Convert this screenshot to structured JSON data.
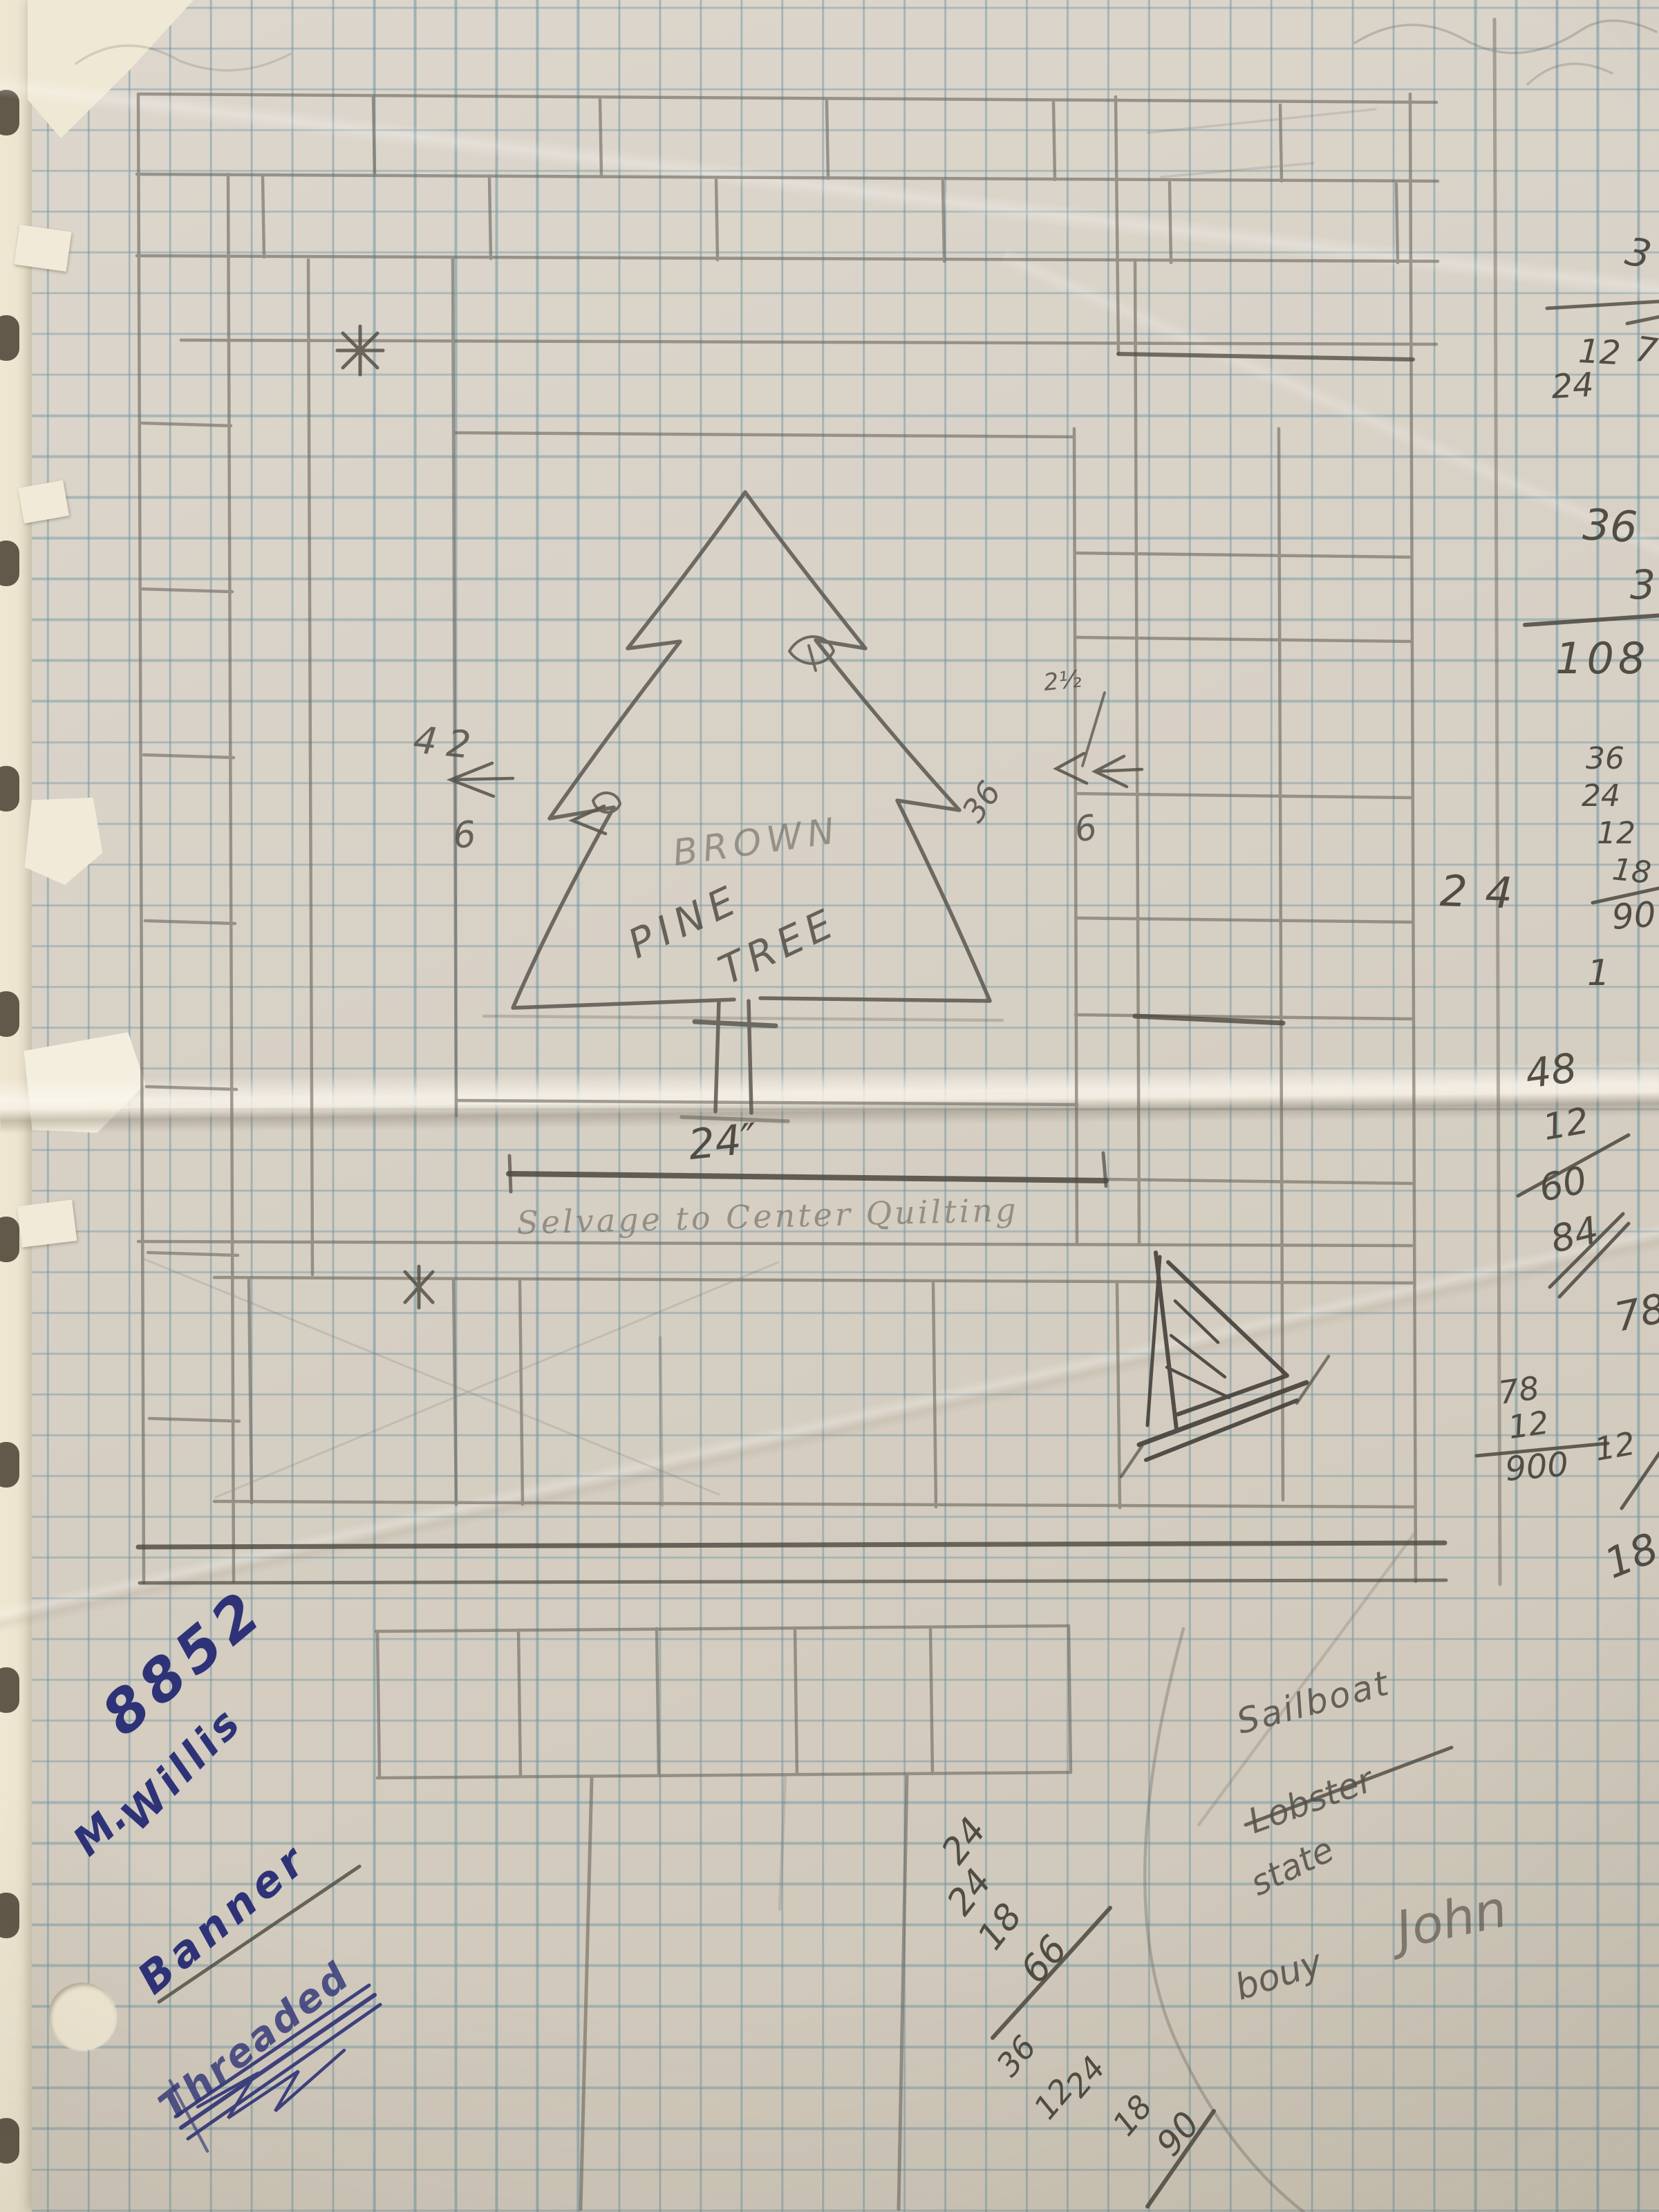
{
  "sketch_labels": {
    "tree_color_word": "BROWN",
    "tree_line1": "PINE",
    "tree_line2": "TREE",
    "center_width": "24″",
    "cursive_note": "Selvage to Center Quilting",
    "left_height": "42",
    "left_small": "6",
    "right_rotated": "36",
    "right_fraction": "2½",
    "right_small": "6"
  },
  "margin_math": {
    "edge_fragment_top": "3",
    "edge_fragment_seven": "7",
    "pair_top": "12",
    "pair_bottom": "24",
    "multiplication": {
      "multiplicand": "36",
      "multiplier": "3",
      "product": "108"
    },
    "addition": {
      "addends": [
        "36",
        "24",
        "12",
        "18"
      ],
      "sum": "90"
    },
    "big_value": "24",
    "lone_one": "1",
    "sequence": {
      "first": "48",
      "crossed_a": "12",
      "second": "60",
      "crossed_b": "84",
      "third": "78"
    },
    "second_addition": {
      "top": "78",
      "addends": [
        "78",
        "12"
      ],
      "sum": "900",
      "crossed": "12",
      "below": "18"
    }
  },
  "bottom_math": {
    "addition_a": {
      "addends": [
        "24",
        "24",
        "18"
      ],
      "sum": "66"
    },
    "addition_b": {
      "addends": [
        "36",
        "12",
        "24",
        "18"
      ],
      "sum": "90"
    }
  },
  "ink_note": {
    "number": "8852",
    "initial": "M.",
    "surname": "Willis",
    "struck_word": "Banner",
    "scribbled_word": "Threaded"
  },
  "pencil_note": {
    "word1": "Sailboat",
    "word2_struck": "Lobster",
    "word3": "state",
    "word4": "bouy",
    "word5": "John"
  }
}
